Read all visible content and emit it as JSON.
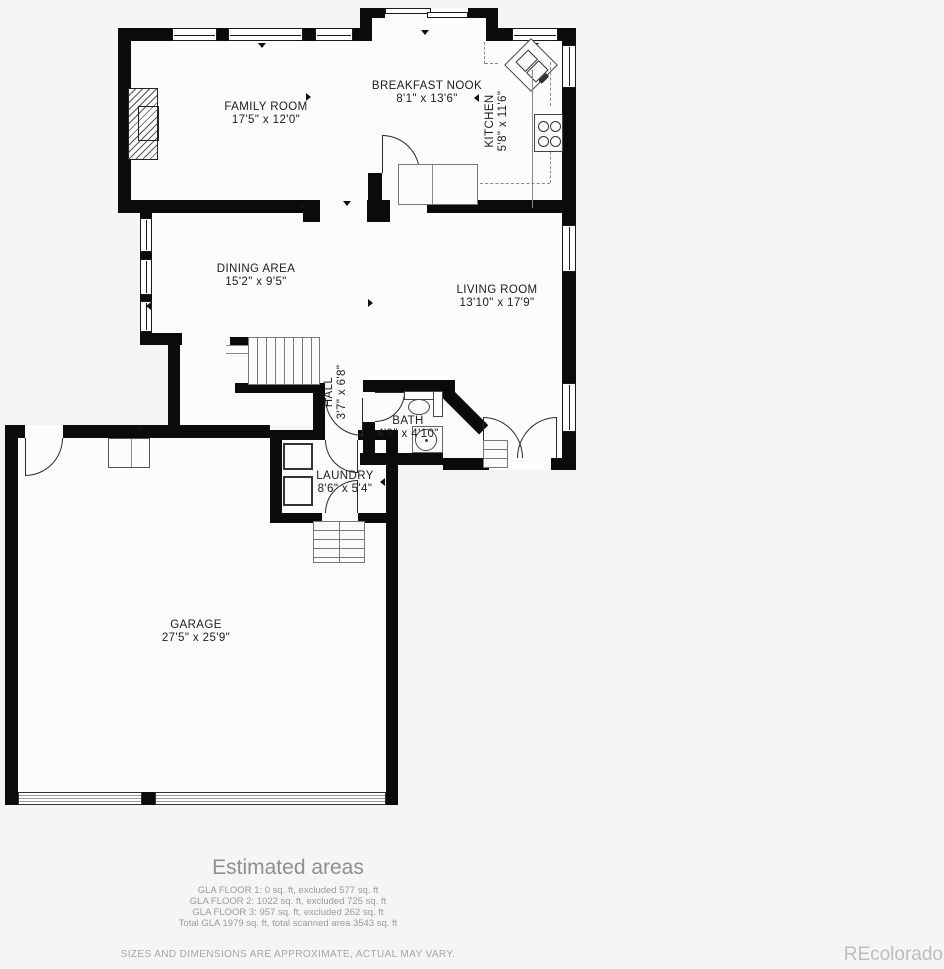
{
  "page": {
    "background": "#f5f5f4",
    "wall_color": "#0b0b0b",
    "room_fill": "#fcfcfb",
    "muted_text": "#9b9b9b"
  },
  "rooms": [
    {
      "name": "FAMILY ROOM",
      "dims": "17'5\" x 12'0\""
    },
    {
      "name": "BREAKFAST NOOK",
      "dims": "8'1\" x 13'6\""
    },
    {
      "name": "KITCHEN",
      "dims": "5'8\" x 11'6\""
    },
    {
      "name": "DINING AREA",
      "dims": "15'2\" x 9'5\""
    },
    {
      "name": "LIVING ROOM",
      "dims": "13'10\" x 17'9\""
    },
    {
      "name": "HALL",
      "dims": "3'7\" x 6'8\""
    },
    {
      "name": "BATH",
      "dims": "4'9\" x 4'10\""
    },
    {
      "name": "LAUNDRY",
      "dims": "8'6\" x 5'4\""
    },
    {
      "name": "GARAGE",
      "dims": "27'5\" x 25'9\""
    }
  ],
  "footer": {
    "title": "Estimated areas",
    "lines": [
      "GLA FLOOR 1: 0 sq. ft, excluded 577 sq. ft",
      "GLA FLOOR 2: 1022 sq. ft, excluded 725 sq. ft",
      "GLA FLOOR 3: 957 sq. ft, excluded 262 sq. ft",
      "Total GLA 1979 sq. ft, total scanned area 3543 sq. ft"
    ],
    "disclaimer": "SIZES AND DIMENSIONS ARE APPROXIMATE, ACTUAL MAY VARY.",
    "watermark": "REcolorado"
  }
}
